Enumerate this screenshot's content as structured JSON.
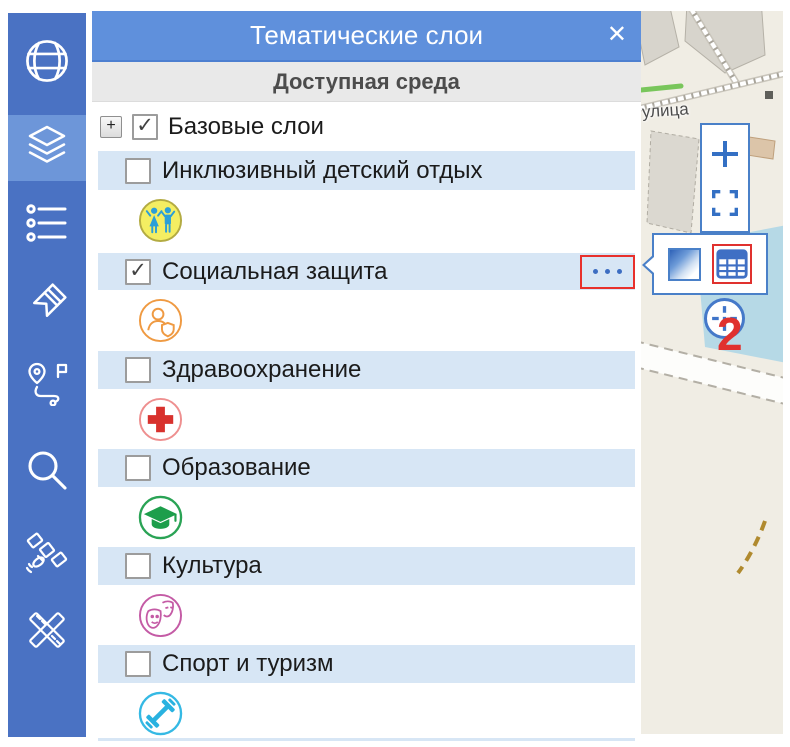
{
  "panel": {
    "title": "Тематические слои",
    "close_glyph": "✕",
    "subtitle": "Доступная среда",
    "check_glyph": "✓",
    "tree": {
      "root": {
        "label": "Базовые слои",
        "checked": true,
        "expander_glyph": "+"
      },
      "layers": [
        {
          "label": "Инклюзивный детский отдых",
          "checked": false,
          "icon": "children-icon"
        },
        {
          "label": "Социальная защита",
          "checked": true,
          "icon": "social-protection-icon",
          "has_options_menu": true
        },
        {
          "label": "Здравоохранение",
          "checked": false,
          "icon": "healthcare-icon"
        },
        {
          "label": "Образование",
          "checked": false,
          "icon": "education-icon"
        },
        {
          "label": "Культура",
          "checked": false,
          "icon": "culture-icon"
        },
        {
          "label": "Спорт и туризм",
          "checked": false,
          "icon": "sport-tourism-icon"
        }
      ]
    }
  },
  "sidebar": {
    "tools": [
      "globe",
      "layers",
      "legend-list",
      "tag",
      "route",
      "search",
      "satellite",
      "measure"
    ],
    "active_tool": "layers"
  },
  "map": {
    "street_label": "улица",
    "controls": {
      "zoom_in": "+",
      "fullscreen": "fullscreen-brackets",
      "locate": "crosshair"
    },
    "layer_popup": {
      "buttons": [
        "opacity-style",
        "attribute-table"
      ],
      "highlighted_button": "attribute-table"
    }
  },
  "annotations": {
    "step1": "1",
    "step2": "2",
    "highlight_color": "#e8302c"
  },
  "colors": {
    "sidebar_blue": "#4a72c3",
    "sidebar_active": "#6d96d9",
    "header_blue": "#5f90dc",
    "row_blue": "#d7e6f5",
    "accent_blue": "#3f6fc4",
    "annotation_red": "#e8302c",
    "children_fill": "#f4ee62",
    "children_figures": "#2b9fd8",
    "social_orange": "#ef9a42",
    "health_red": "#d8312d",
    "education_green": "#1d9e4b",
    "culture_pink": "#c45ba5",
    "sport_cyan": "#2fb5e2",
    "map_bg": "#f0ede4",
    "water": "#b6d9e6"
  }
}
